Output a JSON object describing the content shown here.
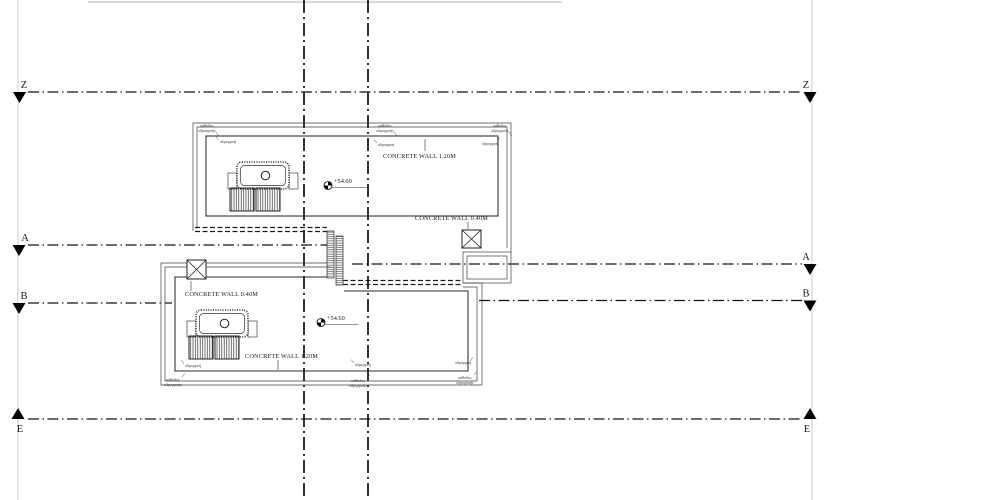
{
  "sections": {
    "z": "Z",
    "a": "A",
    "b": "B",
    "e": "E"
  },
  "walls": {
    "upper_parapet": "CONCRETE WALL 1.20M",
    "upper_right": "CONCRETE WALL 0.40M",
    "lower_left": "CONCRETE WALL 0.40M",
    "lower_parapet": "CONCRETE WALL 1.20M"
  },
  "elevations": {
    "upper": "+54.60",
    "lower": "+54.60"
  },
  "annotations": {
    "gutter": "υδρορροή",
    "downpipe_line1": "κάθοδος",
    "downpipe_line2": "υδρορροής"
  },
  "colors": {
    "ink": "#1a1a1a",
    "faint_guide": "#c6c6c6",
    "background": "#ffffff"
  }
}
